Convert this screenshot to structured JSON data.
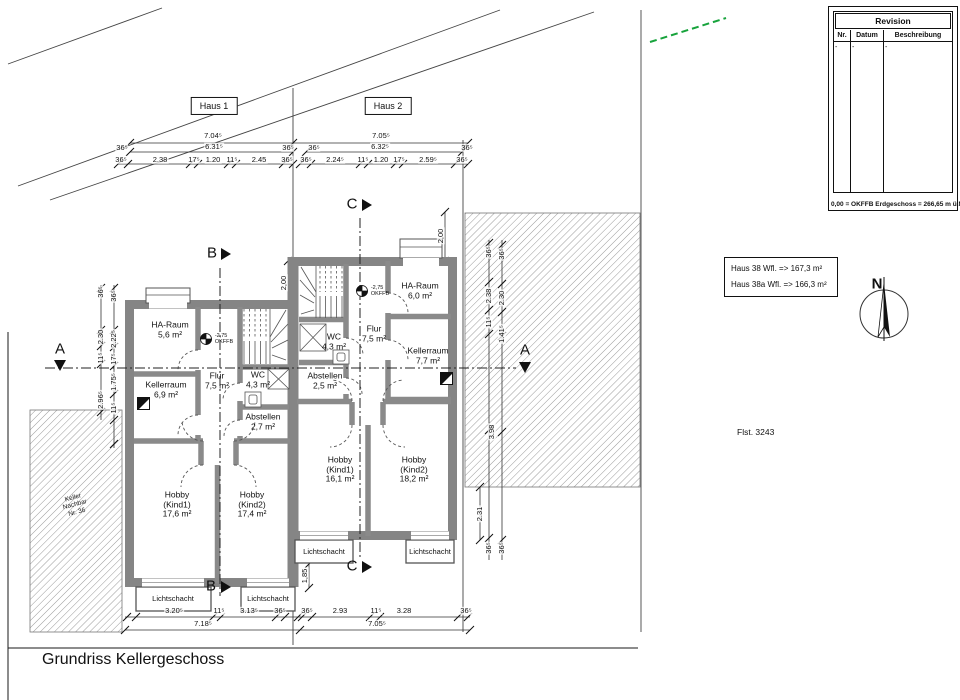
{
  "title": "Grundriss Kellergeschoss",
  "parcel_label": "Flst. 3243",
  "north_label": "N",
  "area_box": {
    "line1": "Haus 38 Wfl.   => 167,3 m²",
    "line2": "Haus 38a Wfl. => 166,3 m²"
  },
  "revision_table": {
    "title": "Revision",
    "columns": [
      "Nr.",
      "Datum",
      "Beschreibung"
    ],
    "rows": [
      [
        "-",
        "-",
        "-"
      ]
    ],
    "note": "0,00 = OKFFB Erdgeschoss = 266,65 m ü.NN"
  },
  "house_tags": [
    {
      "label": "Haus 1",
      "x": 214,
      "y": 106
    },
    {
      "label": "Haus 2",
      "x": 388,
      "y": 106
    }
  ],
  "neighbor_note": {
    "lines": [
      "Keller",
      "Nachbar",
      "Nr. 36"
    ],
    "x": 75,
    "y": 505,
    "r": -15
  },
  "lichtschacht": {
    "label": "Lichtschacht",
    "positions": [
      {
        "x": 173,
        "y": 599
      },
      {
        "x": 268,
        "y": 599
      },
      {
        "x": 324,
        "y": 552
      },
      {
        "x": 430,
        "y": 552
      }
    ]
  },
  "level_markers": {
    "lines": [
      "-2,75",
      "OKFFB"
    ],
    "positions": [
      {
        "x": 224,
        "y": 339
      },
      {
        "x": 380,
        "y": 291
      }
    ]
  },
  "section_markers": [
    {
      "t": "A",
      "x": 60,
      "y": 350
    },
    {
      "t": "A",
      "x": 525,
      "y": 351
    },
    {
      "t": "B",
      "x": 212,
      "y": 254
    },
    {
      "t": "B",
      "x": 211,
      "y": 587
    },
    {
      "t": "C",
      "x": 352,
      "y": 205
    },
    {
      "t": "C",
      "x": 352,
      "y": 567
    }
  ],
  "rooms": [
    {
      "n": "h1-ha-raum",
      "x": 170,
      "y": 330,
      "lines": [
        "HA-Raum",
        "5,6 m²"
      ]
    },
    {
      "n": "h1-kellerraum",
      "x": 166,
      "y": 390,
      "lines": [
        "Kellerraum",
        "6,9 m²"
      ]
    },
    {
      "n": "h1-flur",
      "x": 217,
      "y": 381,
      "lines": [
        "Flur",
        "7,5 m²"
      ]
    },
    {
      "n": "h1-wc",
      "x": 258,
      "y": 380,
      "lines": [
        "WC",
        "4,3 m²"
      ]
    },
    {
      "n": "h1-abstellen",
      "x": 263,
      "y": 422,
      "lines": [
        "Abstellen",
        "2,7 m²"
      ]
    },
    {
      "n": "h1-hobby-kind1",
      "x": 177,
      "y": 505,
      "lines": [
        "Hobby",
        "(Kind1)",
        "17,6 m²"
      ]
    },
    {
      "n": "h1-hobby-kind2",
      "x": 252,
      "y": 505,
      "lines": [
        "Hobby",
        "(Kind2)",
        "17,4 m²"
      ]
    },
    {
      "n": "h2-ha-raum",
      "x": 420,
      "y": 291,
      "lines": [
        "HA-Raum",
        "6,0 m²"
      ]
    },
    {
      "n": "h2-flur",
      "x": 374,
      "y": 334,
      "lines": [
        "Flur",
        "7,5 m²"
      ]
    },
    {
      "n": "h2-wc",
      "x": 334,
      "y": 342,
      "lines": [
        "WC",
        "4,3 m²"
      ]
    },
    {
      "n": "h2-kellerraum",
      "x": 428,
      "y": 356,
      "lines": [
        "Kellerraum",
        "7,7 m²"
      ]
    },
    {
      "n": "h2-abstellen",
      "x": 325,
      "y": 381,
      "lines": [
        "Abstellen",
        "2,5 m²"
      ]
    },
    {
      "n": "h2-hobby-kind1",
      "x": 340,
      "y": 470,
      "lines": [
        "Hobby",
        "(Kind1)",
        "16,1 m²"
      ]
    },
    {
      "n": "h2-hobby-kind2",
      "x": 414,
      "y": 470,
      "lines": [
        "Hobby",
        "(Kind2)",
        "18,2 m²"
      ]
    }
  ],
  "dims": [
    {
      "t": "7.04⁵",
      "x": 213,
      "y": 136
    },
    {
      "t": "6.31⁵",
      "x": 214,
      "y": 147
    },
    {
      "t": "36⁵",
      "x": 122,
      "y": 148
    },
    {
      "t": "36⁵",
      "x": 121,
      "y": 160
    },
    {
      "t": "2.38",
      "x": 160,
      "y": 160
    },
    {
      "t": "17⁵",
      "x": 194,
      "y": 160
    },
    {
      "t": "1.20",
      "x": 213,
      "y": 160
    },
    {
      "t": "11⁵",
      "x": 232,
      "y": 160
    },
    {
      "t": "2.45",
      "x": 259,
      "y": 160
    },
    {
      "t": "36⁵",
      "x": 288,
      "y": 148
    },
    {
      "t": "36⁵",
      "x": 287,
      "y": 160
    },
    {
      "t": "7.05⁵",
      "x": 381,
      "y": 136
    },
    {
      "t": "6.32⁵",
      "x": 380,
      "y": 147
    },
    {
      "t": "36⁵",
      "x": 314,
      "y": 148
    },
    {
      "t": "36⁵",
      "x": 306,
      "y": 160
    },
    {
      "t": "2.24⁵",
      "x": 335,
      "y": 160
    },
    {
      "t": "11⁵",
      "x": 363,
      "y": 160
    },
    {
      "t": "1.20",
      "x": 381,
      "y": 160
    },
    {
      "t": "17⁵",
      "x": 399,
      "y": 160
    },
    {
      "t": "2.59⁵",
      "x": 428,
      "y": 160
    },
    {
      "t": "36⁵",
      "x": 467,
      "y": 148
    },
    {
      "t": "36⁵",
      "x": 462,
      "y": 160
    },
    {
      "t": "3.20⁵",
      "x": 174,
      "y": 611
    },
    {
      "t": "11⁵",
      "x": 219,
      "y": 611
    },
    {
      "t": "3.13⁵",
      "x": 249,
      "y": 611
    },
    {
      "t": "36⁵",
      "x": 280,
      "y": 611
    },
    {
      "t": "7.18⁵",
      "x": 203,
      "y": 624
    },
    {
      "t": "36⁵",
      "x": 307,
      "y": 611
    },
    {
      "t": "2.93",
      "x": 340,
      "y": 611
    },
    {
      "t": "11⁵",
      "x": 376,
      "y": 611
    },
    {
      "t": "3.28",
      "x": 404,
      "y": 611
    },
    {
      "t": "36⁵",
      "x": 466,
      "y": 611
    },
    {
      "t": "7.05⁵",
      "x": 377,
      "y": 624
    },
    {
      "t": "36⁵",
      "x": 101,
      "y": 292,
      "r": -90
    },
    {
      "t": "2.30",
      "x": 101,
      "y": 337,
      "r": -90
    },
    {
      "t": "11⁵",
      "x": 101,
      "y": 358,
      "r": -90
    },
    {
      "t": "2.96⁵",
      "x": 101,
      "y": 400,
      "r": -90
    },
    {
      "t": "36⁵",
      "x": 114,
      "y": 296,
      "r": -90
    },
    {
      "t": "2.22⁵",
      "x": 114,
      "y": 339,
      "r": -90
    },
    {
      "t": "17⁵",
      "x": 114,
      "y": 359,
      "r": -90
    },
    {
      "t": "1.75⁵",
      "x": 114,
      "y": 382,
      "r": -90
    },
    {
      "t": "11⁵",
      "x": 114,
      "y": 408,
      "r": -90
    },
    {
      "t": "36⁵",
      "x": 489,
      "y": 252,
      "r": -90
    },
    {
      "t": "2.38",
      "x": 489,
      "y": 296,
      "r": -90
    },
    {
      "t": "11⁵",
      "x": 489,
      "y": 322,
      "r": -90
    },
    {
      "t": "3.98",
      "x": 492,
      "y": 432,
      "r": -90
    },
    {
      "t": "36⁵",
      "x": 489,
      "y": 548,
      "r": -90
    },
    {
      "t": "36⁵",
      "x": 502,
      "y": 254,
      "r": -90
    },
    {
      "t": "2.30",
      "x": 502,
      "y": 298,
      "r": -90
    },
    {
      "t": "1.41⁵",
      "x": 502,
      "y": 334,
      "r": -90
    },
    {
      "t": "36⁵",
      "x": 502,
      "y": 548,
      "r": -90
    },
    {
      "t": "2.31",
      "x": 480,
      "y": 514,
      "r": -90
    },
    {
      "t": "2,00",
      "x": 284,
      "y": 283,
      "r": -90
    },
    {
      "t": "2,00",
      "x": 441,
      "y": 236,
      "r": -90
    },
    {
      "t": "1,85",
      "x": 305,
      "y": 576,
      "r": -90
    }
  ],
  "colors": {
    "wall": "#858585",
    "hatch": "#9a9a9a",
    "line": "#1a1a1a",
    "green_boundary": "#17a33c"
  }
}
